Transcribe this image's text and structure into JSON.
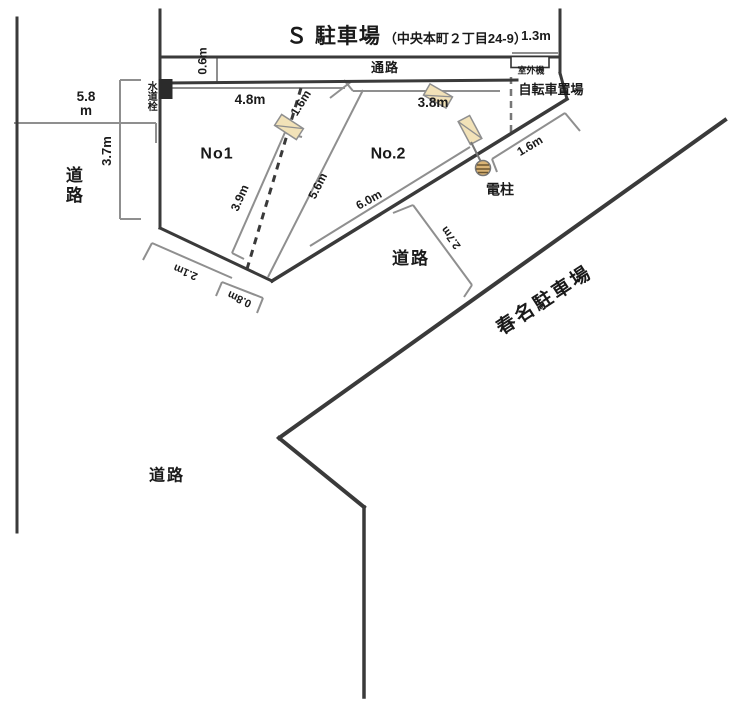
{
  "diagram": {
    "title": "Ｓ 駐車場",
    "title_note": "（中央本町２丁目24-9）",
    "areas": {
      "aisle": "通路",
      "outdoor_unit": "室外機",
      "bicycle": "自転車置場",
      "water_tap": "水道栓",
      "power_pole": "電柱",
      "space_no1": "No1",
      "space_no2": "No.2",
      "road_west": "道路",
      "road_south": "道路",
      "road_lower": "道路",
      "neighbor_parking": "春名駐車場"
    },
    "measurements": {
      "m_1_3": "1.3m",
      "m_0_6": "0.6m",
      "m_5_8_value": "5.8",
      "m_5_8_unit": "m",
      "m_3_7": "3.7m",
      "m_4_8": "4.8m",
      "m_1_6_top": "1.6m",
      "m_3_8": "3.8m",
      "m_3_9": "3.9m",
      "m_5_6": "5.6m",
      "m_6_0": "6.0m",
      "m_1_6_pole": "1.6m",
      "m_2_7": "2.7m",
      "m_2_1": "2.1m",
      "m_0_8": "0.8m"
    },
    "colors": {
      "boundary": "#3a3a3a",
      "measure": "#8f8f8f",
      "marker_fill": "#f2e2b8",
      "pole_fill": "#d9b375"
    }
  }
}
